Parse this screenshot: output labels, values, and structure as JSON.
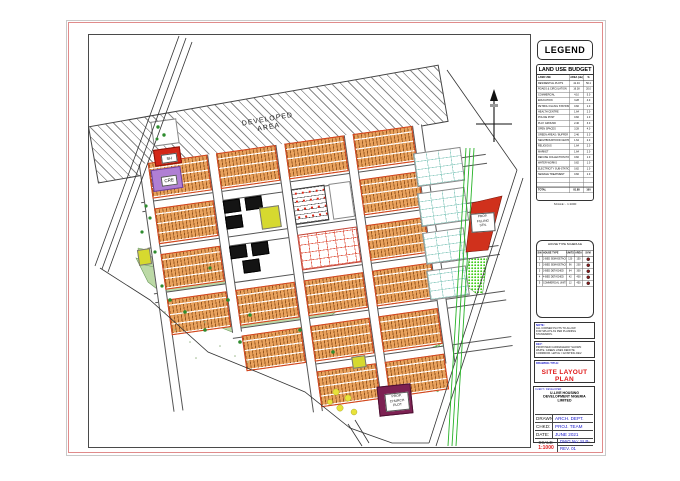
{
  "legend": {
    "title": "LEGEND"
  },
  "land_use_budget": {
    "title": "LAND USE BUDGET",
    "columns": [
      "LAND USE",
      "AREA (Ha)",
      "%"
    ],
    "rows": [
      [
        "RESIDENTIAL PLOTS",
        "41.04",
        "50.1"
      ],
      [
        "ROADS & CIRCULATION",
        "16.38",
        "20.0"
      ],
      [
        "COMMERCIAL",
        "4.10",
        "5.0"
      ],
      [
        "EDUCATION",
        "3.28",
        "4.0"
      ],
      [
        "PETROL FILLING STATION",
        "0.82",
        "1.0"
      ],
      [
        "HEALTH CENTRE",
        "1.64",
        "2.0"
      ],
      [
        "POLICE POST",
        "0.82",
        "1.0"
      ],
      [
        "PLAY GROUND",
        "2.46",
        "3.0"
      ],
      [
        "OPEN SPACES",
        "3.28",
        "4.0"
      ],
      [
        "GREEN AREAS / BUFFER",
        "2.46",
        "3.0"
      ],
      [
        "NEIGHBOURHOOD CENTRE",
        "1.64",
        "2.0"
      ],
      [
        "RELIGIOUS",
        "1.64",
        "2.0"
      ],
      [
        "MARKET",
        "1.64",
        "2.0"
      ],
      [
        "REFUSE COLLECTION POINT",
        "0.82",
        "1.0"
      ],
      [
        "WATER WORKS",
        "0.82",
        "1.0"
      ],
      [
        "ELECTRICITY SUB-STATION",
        "0.82",
        "1.0"
      ],
      [
        "SEWAGE TREATMENT",
        "0.82",
        "1.0"
      ]
    ],
    "total_label": "TOTAL",
    "total_area": "81.88",
    "total_pct": "100"
  },
  "scale_note": "SCALE :- 1:1000",
  "house_schedule": {
    "title": "HOUSE TYPE SCHEDULE",
    "columns": [
      "S/N",
      "HOUSE TYPE",
      "UNITS",
      "AREA",
      "SYM"
    ],
    "rows": [
      [
        "1",
        "2-BED SEMI-DETACHED",
        "120",
        "150"
      ],
      [
        "2",
        "3-BED SEMI-DETACHED",
        "96",
        "200"
      ],
      [
        "3",
        "3-BED DETACHED",
        "64",
        "300"
      ],
      [
        "4",
        "4-BED DETACHED",
        "42",
        "400"
      ],
      [
        "5",
        "COMMERCIAL UNITS",
        "12",
        "450"
      ]
    ],
    "caption": "ALL AREAS ARE IN SQUARE METRES",
    "symbol_color": "#8b1a1a"
  },
  "notes": [
    {
      "heading": "NOTE:",
      "lines": [
        "ALL CORNER PLOTS TO ALLOW",
        "FOR SPLAYS AS PER PLANNING",
        "STANDARDS."
      ]
    },
    {
      "heading": "KEY:",
      "lines": [
        "PROPOSED CARRIAGEWAY SHOWN",
        "WHITE. GREEN LINES DENOTE",
        "CORRIDOR. HATCH = EXISTING DEV."
      ]
    }
  ],
  "plan_box": {
    "label": "DRAWING TITLE:",
    "title": "SITE LAYOUT PLAN"
  },
  "title_block": {
    "label": "CLIENT / DEVELOPER:",
    "company_lines": [
      "U-LIVE HOUSING",
      "DEVELOPMENT NIGERIA",
      "LIMITED"
    ],
    "fields": [
      {
        "label": "DRAWN:",
        "value": "ARCH. DEPT."
      },
      {
        "label": "CHKD:",
        "value": "PROJ. TEAM"
      },
      {
        "label": "DATE:",
        "value": "JUNE 2021"
      }
    ],
    "scale_label": "SCALE:",
    "scale_value": "1:1000",
    "dwg_value": "DWG No: SLP-01",
    "rev_value": "REV. 01"
  },
  "drawing": {
    "developed_area": [
      "DEVELOPED",
      "AREA"
    ],
    "red_parcel_label": [
      "PROP.",
      "FILLING",
      "STN."
    ],
    "maroon_parcel_label": [
      "PROP.",
      "CHURCH",
      "PLOT"
    ],
    "purple_block_label": "CRE",
    "red_block_label": "SH"
  },
  "colors": {
    "housing_fill": "#e9a25d",
    "housing_border": "#d1431f",
    "park_green": "#bcd9a6",
    "speckle_green": "#3ecc17",
    "corridor_green": "#27b227",
    "red_parcel": "#d0311c",
    "maroon_parcel": "#7d2153",
    "purple_block": "#b07fd4",
    "red_block": "#d42718",
    "yellow_block": "#d6d92f"
  }
}
